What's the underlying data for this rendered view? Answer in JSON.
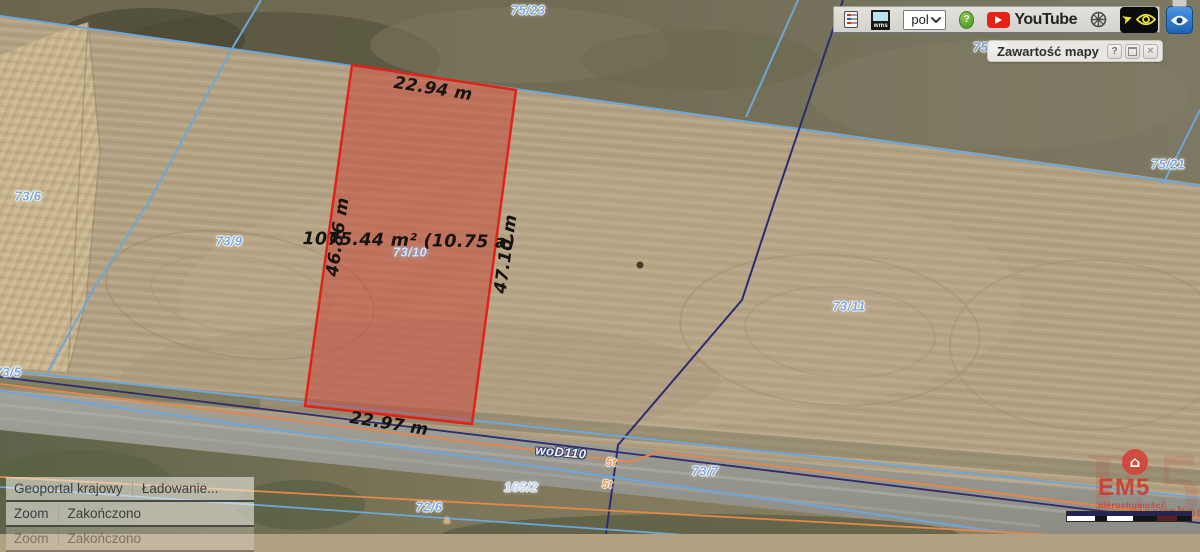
{
  "toolbar": {
    "wms_label": "wms",
    "language_value": "pol",
    "help_label": "?",
    "youtube_label": "YouTube"
  },
  "map_panel": {
    "title": "Zawartość mapy",
    "help_label": "?",
    "close_label": "×"
  },
  "status": {
    "rows": [
      {
        "source": "Geoportal krajowy",
        "message": "Ładowanie...",
        "faded": false
      },
      {
        "source": "Zoom",
        "message": "Zakończono",
        "faded": false
      },
      {
        "source": "Zoom",
        "message": "Zakończono",
        "faded": true
      }
    ]
  },
  "watermark": {
    "big_letters": "E5",
    "house_icon": "⌂",
    "brand": "EM5",
    "tagline": "nieruchomości",
    "tagline_fragment": "nieruchomości"
  },
  "map_labels": [
    {
      "name": "parcel-label-75-23",
      "text": "75/23",
      "x": 528,
      "y": 10,
      "cls": "plabel"
    },
    {
      "name": "parcel-label-75-22",
      "text": "75/22",
      "x": 990,
      "y": 47,
      "cls": "plabel dim"
    },
    {
      "name": "parcel-label-75-21",
      "text": "75/21",
      "x": 1168,
      "y": 164,
      "cls": "plabel"
    },
    {
      "name": "parcel-label-73-6",
      "text": "73/6",
      "x": 28,
      "y": 196,
      "cls": "plabel"
    },
    {
      "name": "parcel-label-73-9",
      "text": "73/9",
      "x": 229,
      "y": 241,
      "cls": "plabel"
    },
    {
      "name": "parcel-label-73-11",
      "text": "73/11",
      "x": 849,
      "y": 306,
      "cls": "plabel"
    },
    {
      "name": "parcel-label-73-5",
      "text": "73/5",
      "x": 8,
      "y": 372,
      "cls": "plabel"
    },
    {
      "name": "parcel-label-73-7",
      "text": "73/7",
      "x": 705,
      "y": 471,
      "cls": "plabel"
    },
    {
      "name": "parcel-label-72-6",
      "text": "72/6",
      "x": 429,
      "y": 507,
      "cls": "plabel"
    },
    {
      "name": "parcel-label-165-2",
      "text": "165/2",
      "x": 521,
      "y": 487,
      "cls": "plabel light"
    },
    {
      "name": "parcel-label-73-10",
      "text": "73/10",
      "x": 410,
      "y": 252,
      "cls": "plabel bright"
    },
    {
      "name": "road-class-label",
      "text": "woD110",
      "x": 561,
      "y": 452,
      "rot": 5,
      "cls": "roadlabel"
    },
    {
      "name": "weight-limit-label",
      "text": "5t",
      "x": 611,
      "y": 462,
      "rot": 3,
      "cls": "wlabel"
    },
    {
      "name": "weight-limit-label",
      "text": "5t",
      "x": 607,
      "y": 484,
      "rot": 3,
      "cls": "wlabel"
    },
    {
      "name": "measure-top-edge",
      "text": "22.94 m",
      "x": 433,
      "y": 89,
      "rot": 9,
      "cls": "measure"
    },
    {
      "name": "measure-left-edge",
      "text": "46.86 m",
      "x": 338,
      "y": 237,
      "rot": -82,
      "cls": "measure"
    },
    {
      "name": "measure-right-edge",
      "text": "47.10 m",
      "x": 506,
      "y": 254,
      "rot": -82,
      "cls": "measure"
    },
    {
      "name": "measure-bottom-edge",
      "text": "22.97 m",
      "x": 389,
      "y": 424,
      "rot": 9,
      "cls": "measure"
    },
    {
      "name": "measure-area",
      "text": "1075.44 m² (10.75 a)",
      "x": 409,
      "y": 241,
      "rot": 1,
      "cls": "measure area"
    },
    {
      "name": "road-marker",
      "text": "▲",
      "x": 447,
      "y": 520,
      "cls": "marker"
    }
  ],
  "colors": {
    "parcel_fill": "#c74234",
    "parcel_stroke": "#df2318",
    "boundary_cyan": "#6fa6d8",
    "boundary_navy": "#2c2c72",
    "road_orange": "#e2884a",
    "label_blue": "#7ea9dd",
    "brand_red": "#cd372d"
  }
}
